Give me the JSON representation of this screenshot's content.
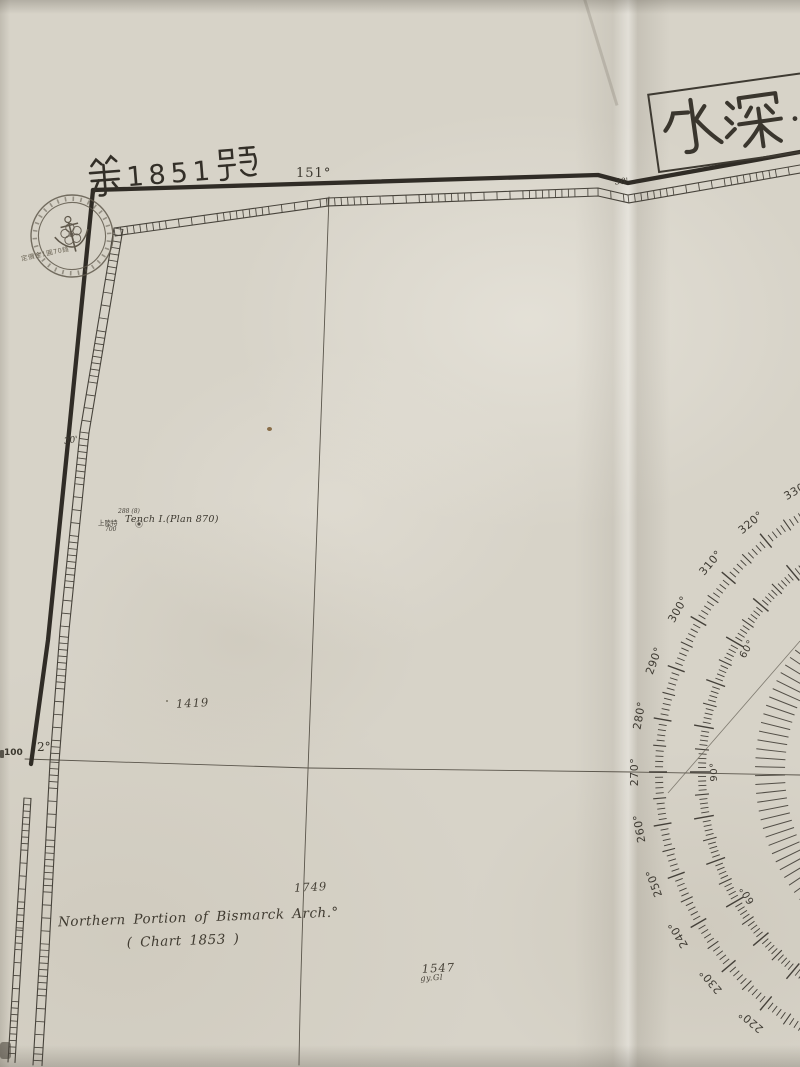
{
  "chart": {
    "sheet_number": "第 1851 號",
    "sheet_digits": "1851",
    "banner_title": "水深…",
    "seal_price": "定價金1圓70錢",
    "top_longitude": "151°",
    "top_minutes": "30'",
    "left_minutes": "30'",
    "left_latitude": "2°",
    "left_edge_number": "100",
    "island": {
      "jp_note": "上陸特",
      "name": "Tench I.(Plan 870)",
      "figure_top": "288 (8)",
      "figure_bottom": "700"
    },
    "region_title_1": "Northern Portion of Bismarck Arch.°",
    "region_title_2": "( Chart   1853 )",
    "soundings": [
      {
        "value": "1419",
        "x": 176,
        "y": 696,
        "quality": ""
      },
      {
        "value": "1749",
        "x": 294,
        "y": 880,
        "quality": ""
      },
      {
        "value": "1547",
        "x": 422,
        "y": 961,
        "quality": "gy.Gl"
      }
    ]
  },
  "compass": {
    "outer_labels": [
      {
        "bearing": 220,
        "text": "220°"
      },
      {
        "bearing": 230,
        "text": "230°"
      },
      {
        "bearing": 240,
        "text": "240°"
      },
      {
        "bearing": 250,
        "text": "250°"
      },
      {
        "bearing": 260,
        "text": "260°"
      },
      {
        "bearing": 270,
        "text": "270°"
      },
      {
        "bearing": 280,
        "text": "280°"
      },
      {
        "bearing": 290,
        "text": "290°"
      },
      {
        "bearing": 300,
        "text": "300°"
      },
      {
        "bearing": 310,
        "text": "310°"
      },
      {
        "bearing": 320,
        "text": "320°"
      },
      {
        "bearing": 330,
        "text": "330°"
      }
    ],
    "inner_labels": [
      {
        "bearing": 240,
        "text": "60°"
      },
      {
        "bearing": 270,
        "text": "90°"
      },
      {
        "bearing": 300,
        "text": "60°"
      }
    ]
  },
  "colors": {
    "paper": "#d7d3c8",
    "ink": "#3b372e",
    "border": "#302c26",
    "compass": "#45413a"
  }
}
